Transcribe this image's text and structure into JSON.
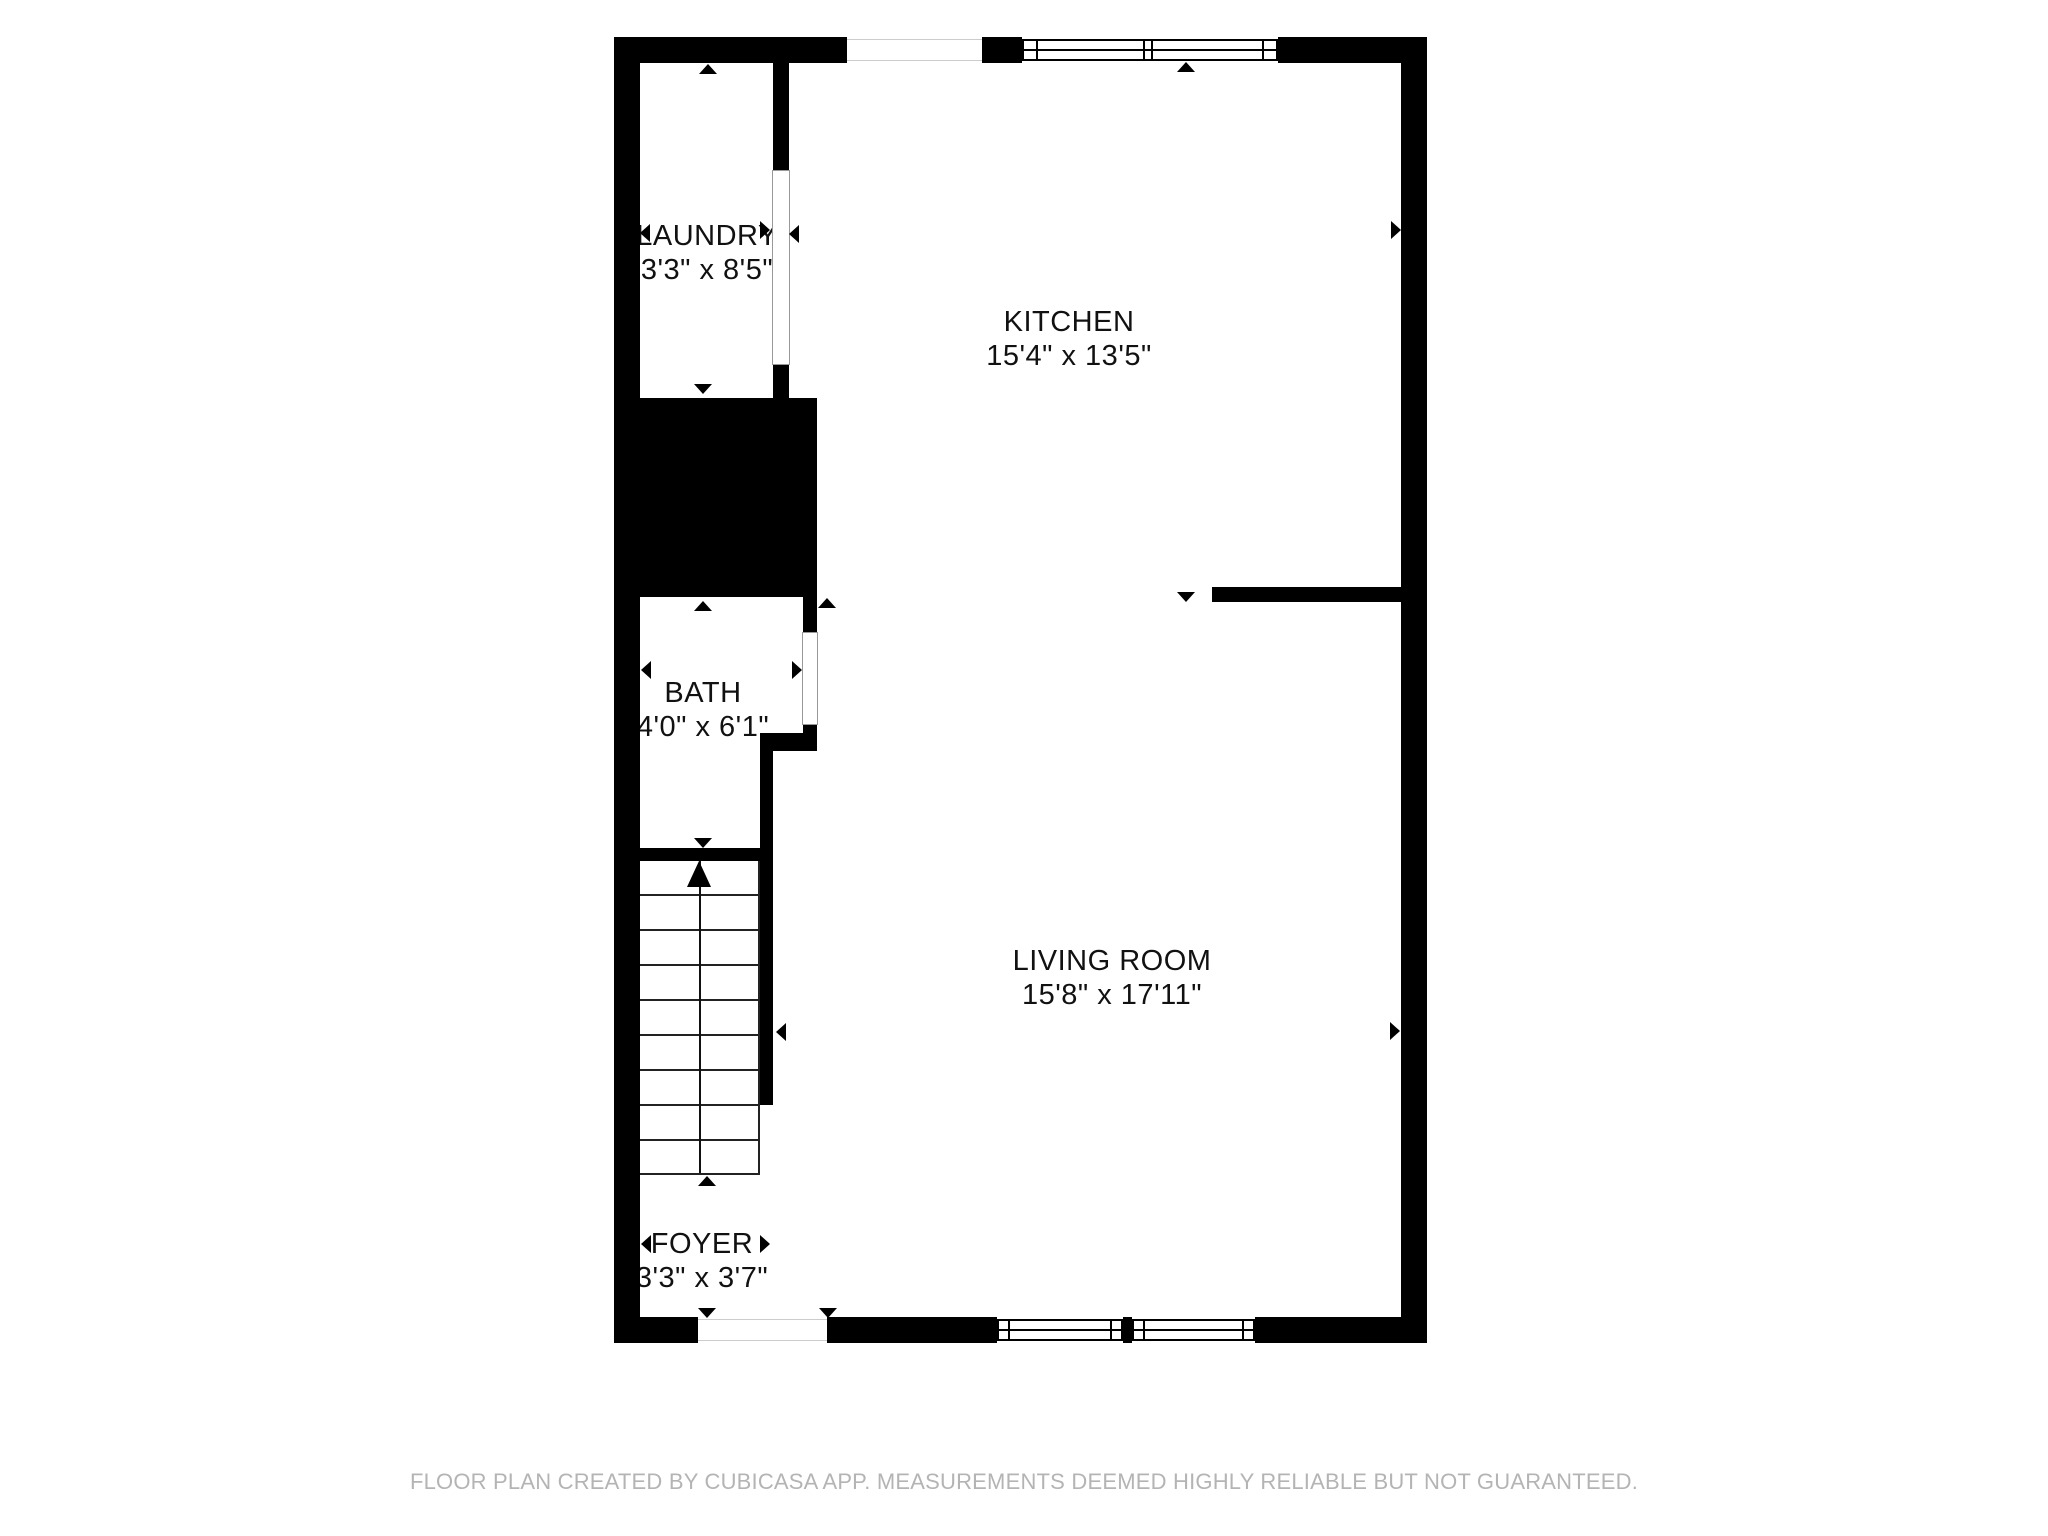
{
  "rooms": [
    {
      "id": "laundry",
      "name": "LAUNDRY",
      "dims": "3'3\" x 8'5\""
    },
    {
      "id": "kitchen",
      "name": "KITCHEN",
      "dims": "15'4\" x 13'5\""
    },
    {
      "id": "bath",
      "name": "BATH",
      "dims": "4'0\" x 6'1\""
    },
    {
      "id": "living-room",
      "name": "LIVING ROOM",
      "dims": "15'8\" x 17'11\""
    },
    {
      "id": "foyer",
      "name": "FOYER",
      "dims": "3'3\" x 3'7\""
    }
  ],
  "footer": {
    "text": "FLOOR PLAN CREATED BY CUBICASA APP. MEASUREMENTS DEEMED HIGHLY RELIABLE BUT NOT GUARANTEED."
  },
  "colors": {
    "wall": "#000000",
    "floor": "#ffffff",
    "label_text": "#111111",
    "footer_text": "#b4b4b4"
  }
}
